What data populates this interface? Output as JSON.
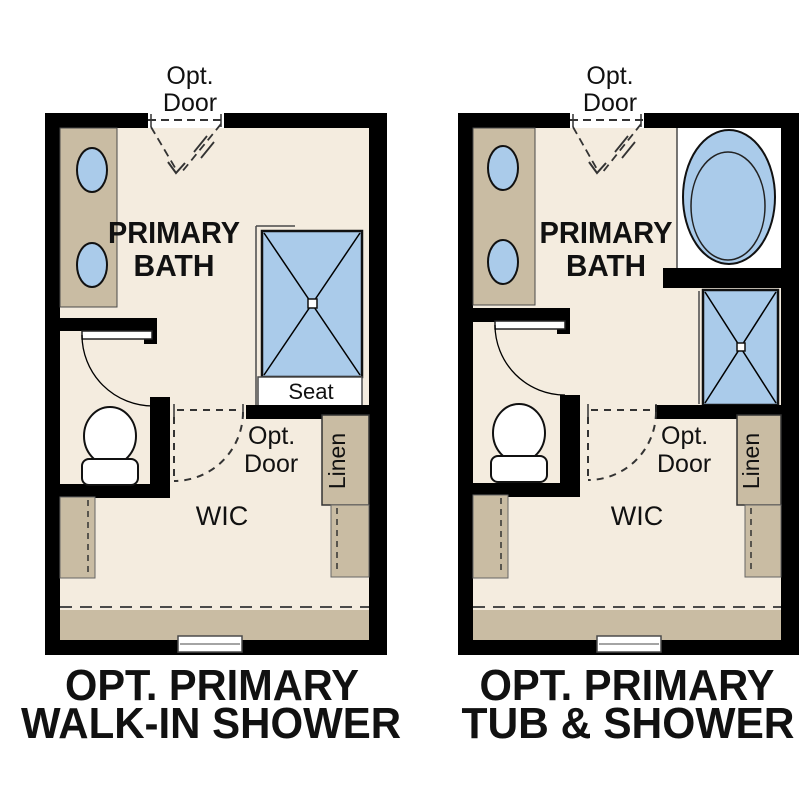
{
  "palette": {
    "background": "#ffffff",
    "floor": "#f4ecdf",
    "cabinet": "#c9bca3",
    "fixture": "#aacbea",
    "wall": "#000000",
    "outline": "#4a4a4a",
    "dashline": "#333333",
    "text": "#111111",
    "white": "#ffffff"
  },
  "labels": {
    "opt": "Opt.",
    "door": "Door",
    "primary": "PRIMARY",
    "bath": "BATH",
    "seat": "Seat",
    "wic": "WIC",
    "linen": "Linen"
  },
  "plans": [
    {
      "caption_line1": "OPT. PRIMARY",
      "caption_line2": "WALK-IN SHOWER"
    },
    {
      "caption_line1": "OPT. PRIMARY",
      "caption_line2": "TUB & SHOWER"
    }
  ]
}
